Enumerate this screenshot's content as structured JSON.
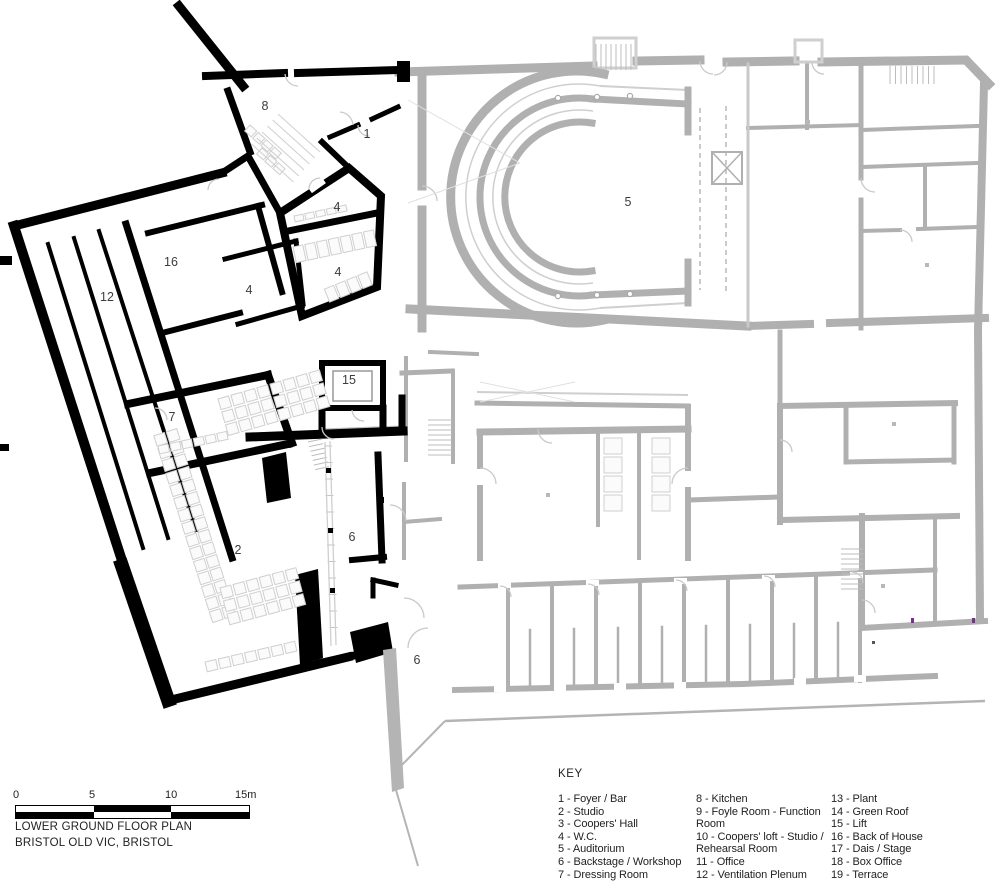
{
  "plan": {
    "type": "architectural-floor-plan",
    "title": "LOWER GROUND FLOOR PLAN",
    "subtitle": "BRISTOL OLD VIC, BRISTOL",
    "room_labels": [
      {
        "number": "1",
        "x": 367,
        "y": 134
      },
      {
        "number": "2",
        "x": 238,
        "y": 550
      },
      {
        "number": "4",
        "x": 337,
        "y": 207
      },
      {
        "number": "4",
        "x": 338,
        "y": 272
      },
      {
        "number": "4",
        "x": 249,
        "y": 290
      },
      {
        "number": "5",
        "x": 628,
        "y": 202
      },
      {
        "number": "6",
        "x": 352,
        "y": 537
      },
      {
        "number": "6",
        "x": 417,
        "y": 660
      },
      {
        "number": "7",
        "x": 172,
        "y": 417
      },
      {
        "number": "8",
        "x": 265,
        "y": 106
      },
      {
        "number": "12",
        "x": 107,
        "y": 297
      },
      {
        "number": "15",
        "x": 349,
        "y": 380
      },
      {
        "number": "16",
        "x": 171,
        "y": 262
      }
    ]
  },
  "scale_bar": {
    "tick_labels": [
      "0",
      "5",
      "10",
      "15m"
    ]
  },
  "key": {
    "heading": "KEY",
    "columns": [
      {
        "items": [
          "1 - Foyer / Bar",
          "2 - Studio",
          "3 - Coopers' Hall",
          "4 - W.C.",
          "5 - Auditorium",
          "6 - Backstage / Workshop",
          "7 - Dressing Room"
        ]
      },
      {
        "items": [
          "8 - Kitchen",
          "9 - Foyle Room - Function Room",
          "10 - Coopers' loft - Studio / Rehearsal Room",
          "11 - Office",
          "12 - Ventilation Plenum"
        ]
      },
      {
        "items": [
          "13 - Plant",
          "14 - Green Roof",
          "15 - Lift",
          "16 - Back of House",
          "17 - Dais / Stage",
          "18 - Box Office",
          "19 - Terrace"
        ]
      }
    ]
  },
  "colors": {
    "new_build_walls": "#000000",
    "historic_walls": "#b0b0b0",
    "label_text": "#3c3c3c",
    "marker_accent": "#7b2d8e"
  }
}
